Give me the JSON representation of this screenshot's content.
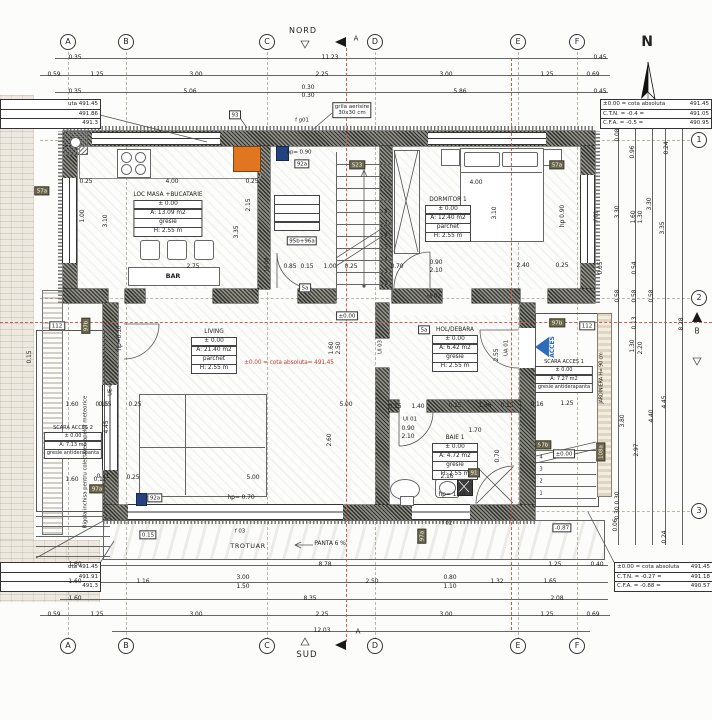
{
  "compass": {
    "n": "N",
    "nord": "NORD",
    "sud": "SUD"
  },
  "sections": {
    "a": "A",
    "b": "B"
  },
  "grid_cols": [
    "A",
    "B",
    "C",
    "D",
    "E",
    "F"
  ],
  "grid_rows": [
    "1",
    "2",
    "3"
  ],
  "tables": {
    "tr": [
      [
        "±0.00 = cota absoluta",
        "491.45"
      ],
      [
        "C.T.N. = -0.4 =",
        "491.05"
      ],
      [
        "C.F.A. = -0.5 =",
        "490.95"
      ]
    ],
    "br": [
      [
        "±0.00 = cota absoluta",
        "491.45"
      ],
      [
        "C.T.N. = -0.27 =",
        "491.18"
      ],
      [
        "C.F.A. = -0.88 =",
        "490.57"
      ]
    ],
    "tl": [
      "uta 491.45",
      "491.86",
      "491.3"
    ],
    "bl": [
      "uta 491.45",
      "491.91",
      "491.3"
    ]
  },
  "rooms": {
    "kitchen": {
      "name": "LOC MASA +BUCATARIE",
      "level": "± 0.00",
      "area": "A: 13.09 m2",
      "floor": "gresie",
      "height": "H: 2.55 m"
    },
    "bedroom": {
      "name": "DORMITOR 1",
      "level": "± 0.00",
      "area": "A: 12.40 m2",
      "floor": "parchet",
      "height": "H: 2.55 m"
    },
    "living": {
      "name": "LIVING",
      "level": "± 0.00",
      "area": "A: 21.40 m2",
      "floor": "parchet",
      "height": "H: 2.55 m"
    },
    "hall": {
      "name": "HOL/DEBARA",
      "level": "± 0.00",
      "area": "A: 6.42 m2",
      "floor": "gresie",
      "height": "H: 2.55 m"
    },
    "bath": {
      "name": "BAIE 1",
      "level": "± 0.00",
      "area": "A: 4.72 m2",
      "floor": "gresie",
      "height": "H: 2.55 m"
    },
    "stair1": {
      "name": "SCARA ACCES 1",
      "level": "± 0.00",
      "area": "A: 7.27 m2",
      "floor": "gresie antiderapanta"
    },
    "stair2": {
      "name": "SCARA ACCES 2",
      "level": "± 0.00",
      "area": "A: 7.13 m2",
      "floor": "gresie antiderapanta"
    }
  },
  "labels": {
    "bar": "BAR",
    "trotuar": "TROTUAR",
    "panta": "PANTA 6 %",
    "grila1": "grila aerisire",
    "grila2": "30x30 cm",
    "rigola": "Rigola inchisa pentru colectarea apelor meteorice",
    "jardiniera": "JARDINIERA H= 90 cm",
    "acces": "ACCES",
    "cota_living": "±0.00 = cota absoluta= 491.45",
    "lvl0": "±0.00",
    "m087": "-0.87",
    "hp090": "hp= 0.90",
    "t93": "93",
    "fg01": "f g01",
    "f01": "f 01",
    "f02": "f 02",
    "f03": "f 03",
    "t92a": "92a",
    "s23": "S23",
    "t95": "95b+96a",
    "t5a": "5a",
    "t112": "112",
    "t97a": "97a",
    "t97b": "97b",
    "t108a": "108a",
    "t57a": "57a",
    "t91": "91",
    "t015": "0.15",
    "ui01": "UI 01",
    "ui02": "UI 02",
    "ui03": "UI 03",
    "ui04": "UI 04",
    "ua01": "UA 01",
    "ue01": "UE 01",
    "nums": [
      "1",
      "2",
      "3",
      "4",
      "5",
      "6",
      "7",
      "8"
    ]
  },
  "dims": {
    "t1": [
      "0.35",
      "11.23",
      "0.45"
    ],
    "t2": [
      "0.59",
      "1.25",
      "3.00",
      "2.25",
      "3.00",
      "1.25",
      "0.69"
    ],
    "t3": [
      "0.35",
      "5.06",
      "0.30",
      "0.30",
      "5.86",
      "0.45"
    ],
    "b1": [
      "1.60",
      "8.78",
      "1.25",
      "0.40"
    ],
    "b2": [
      "1.60",
      "1.16",
      "3.00",
      "1.50",
      "2.50",
      "0.80",
      "1.10",
      "1.32",
      "1.65"
    ],
    "b3": [
      "1.60",
      "8.35",
      "2.08"
    ],
    "b4": [
      "0.59",
      "1.25",
      "3.00",
      "2.25",
      "3.00",
      "1.25",
      "0.69"
    ],
    "b5": [
      "12.03"
    ],
    "right": [
      "0.08",
      "0.96",
      "0.24",
      "3.30",
      "1.60",
      "1.30",
      "3.30",
      "3.35",
      "0.05",
      "0.54",
      "0.58",
      "0.58",
      "0.58",
      "8.28",
      "0.13",
      "1.30",
      "2.20",
      "3.80",
      "2.97",
      "4.40",
      "4.45",
      "0.30",
      "0.30",
      "0.06",
      "0.24"
    ],
    "inner": [
      "0.25",
      "4.00",
      "0.25",
      "3.10",
      "1.00",
      "2.15",
      "3.35",
      "2.75",
      "0.85",
      "0.15",
      "1.00",
      "0.25",
      "0.70",
      "0.90",
      "2.10",
      "2.40",
      "0.25",
      "4.00",
      "3.10",
      "hp 0.90",
      "5.00",
      "0.15",
      "0.25",
      "5.00",
      "0.11",
      "0.25",
      "2.60",
      "4.45",
      "hp=0.10",
      "hp= 0.70",
      "1.60",
      "2.50",
      "2.55",
      "0.15",
      "1.40",
      "0.15",
      "1.36",
      "0.15",
      "0.90",
      "2.10",
      "1.70",
      "2.16",
      "hp= 1.10",
      "0.70",
      "0.16",
      "1.25",
      "1.60",
      "0.15",
      "1.60",
      "0.11",
      "0.15"
    ]
  }
}
